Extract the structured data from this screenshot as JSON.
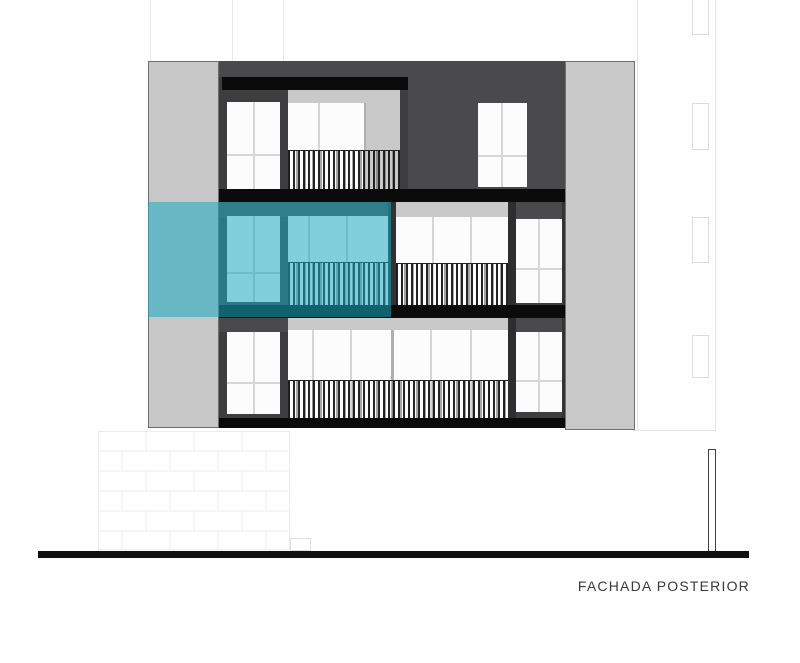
{
  "label": {
    "text": "FACHADA POSTERIOR"
  },
  "colors": {
    "highlight": "rgba(23,170,193,0.55)",
    "wall_light": "#c7c7c8",
    "wall_medium": "#c9c9ca",
    "volume_dark": "#4a4a4c",
    "frame_dark": "#3e3e40",
    "slab_black": "#0b0b0b",
    "window_white": "#fcfcfc",
    "mullion_gray": "#d6d6d6",
    "ground": "#101010",
    "faint": "#e9e9e9",
    "label_text": "#3a3a3a"
  }
}
